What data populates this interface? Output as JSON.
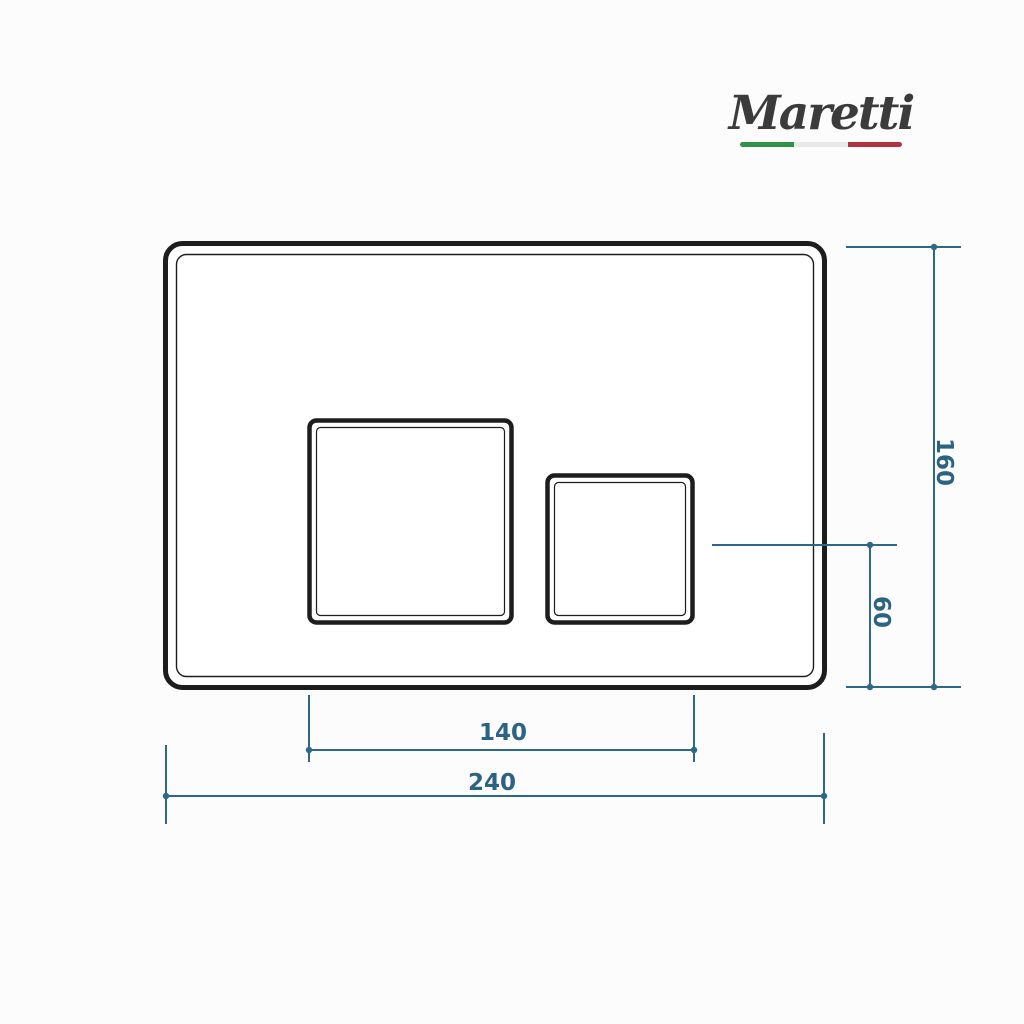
{
  "page": {
    "background_color": "#fcfcfc",
    "content": "technical dimension drawing of a toilet flush plate"
  },
  "brand": {
    "name": "Maretti",
    "text_color": "#3b3b3b",
    "flag_bar": {
      "green": "#2e9348",
      "white": "#e9e9e9",
      "red": "#b0343f"
    }
  },
  "drawing": {
    "subject": "rectangular flush plate, front view, with one large and one small square button",
    "outline_color": "#1d1d1d",
    "dimension_color": "#2e6888",
    "dimensions": {
      "plate_width": "240",
      "plate_height": "160",
      "buttons_span": "140",
      "button_axis_to_bottom": "60"
    }
  }
}
